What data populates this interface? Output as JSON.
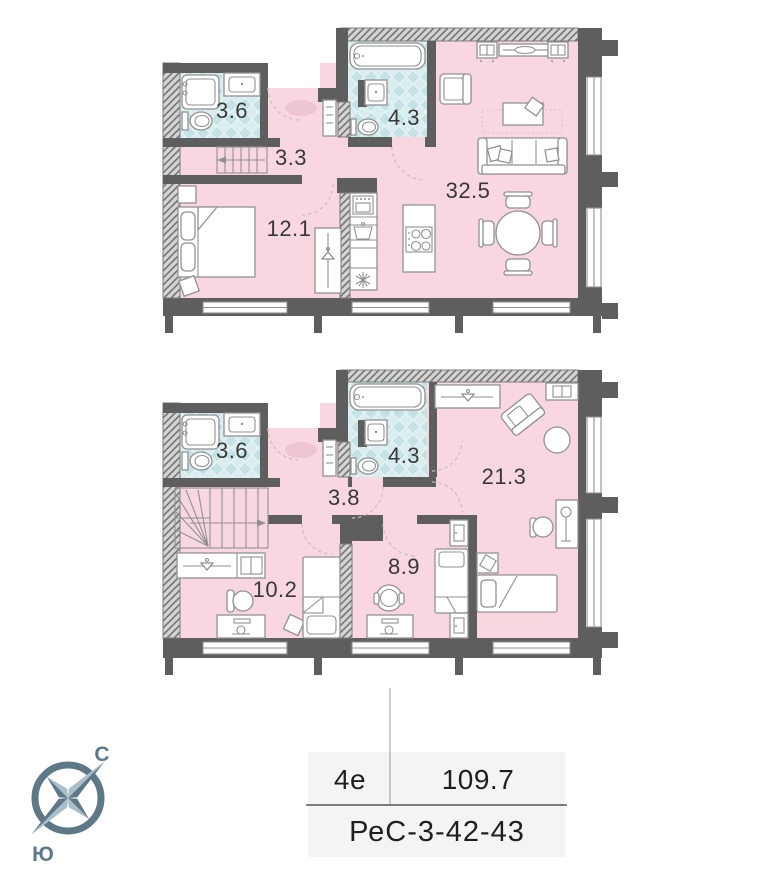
{
  "floors": [
    {
      "label": "upper-level",
      "rooms": [
        {
          "name": "bathroom",
          "area": "3.6"
        },
        {
          "name": "hallway",
          "area": "3.3"
        },
        {
          "name": "bathroom-2",
          "area": "4.3"
        },
        {
          "name": "living-kitchen",
          "area": "32.5"
        },
        {
          "name": "bedroom",
          "area": "12.1"
        }
      ]
    },
    {
      "label": "lower-level",
      "rooms": [
        {
          "name": "bathroom",
          "area": "3.6"
        },
        {
          "name": "bathroom-2",
          "area": "4.3"
        },
        {
          "name": "hallway",
          "area": "3.8"
        },
        {
          "name": "bedroom",
          "area": "21.3"
        },
        {
          "name": "bedroom-2",
          "area": "10.2"
        },
        {
          "name": "bedroom-3",
          "area": "8.9"
        }
      ]
    }
  ],
  "info": {
    "plan_type": "4е",
    "total_area": "109.7",
    "apartment_code": "РеС-3-42-43"
  },
  "compass": {
    "north": "С",
    "south": "Ю"
  },
  "colors": {
    "floor_pink": "#f8d7e0",
    "tile_teal": "#cfe7e9",
    "wall_gray": "#5e5e5e",
    "compass_slate": "#5d7887",
    "table_bg": "#f4f4f4"
  }
}
